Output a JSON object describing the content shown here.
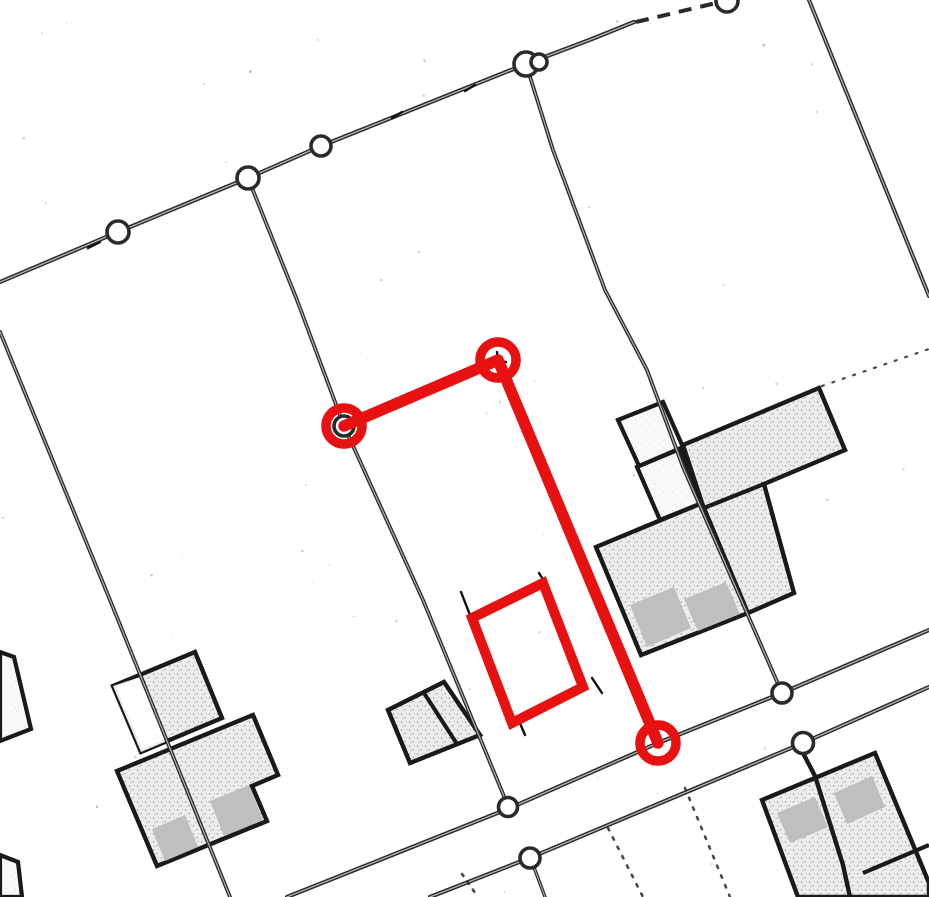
{
  "canvas": {
    "width": 929,
    "height": 897,
    "background": "#ffffff"
  },
  "palette": {
    "line": "#2a2a2a",
    "line_core": "#c9c9c9",
    "building_outline": "#1a1a1a",
    "stipple_bg": "#ededed",
    "stipple_light_bg": "#f9f9f9",
    "patch_gray": "#bfbfbf",
    "faint": "#a0a0a0",
    "speckle": "#9a9a9a",
    "red": "#e81111",
    "white": "#ffffff"
  },
  "roads": [
    {
      "name": "road-top",
      "width": 4.2,
      "points": [
        [
          0,
          282
        ],
        [
          118,
          232
        ],
        [
          248,
          178
        ],
        [
          321,
          146
        ],
        [
          526,
          64
        ],
        [
          592,
          39
        ],
        [
          634,
          22
        ]
      ]
    },
    {
      "name": "road-upper",
      "width": 4.2,
      "points": [
        [
          287,
          897
        ],
        [
          510,
          808
        ],
        [
          658,
          743
        ],
        [
          782,
          693
        ],
        [
          929,
          630
        ]
      ]
    },
    {
      "name": "road-lower",
      "width": 4.2,
      "points": [
        [
          430,
          897
        ],
        [
          532,
          857
        ],
        [
          803,
          743
        ],
        [
          929,
          687
        ]
      ]
    },
    {
      "name": "line-top-right",
      "width": 4.0,
      "points": [
        [
          809,
          0
        ],
        [
          929,
          296
        ]
      ]
    }
  ],
  "parcel_lines": [
    {
      "name": "parcel-line-a",
      "width": 3.8,
      "points": [
        [
          248,
          178
        ],
        [
          297,
          300
        ],
        [
          344,
          426
        ],
        [
          423,
          600
        ],
        [
          508,
          806
        ]
      ]
    },
    {
      "name": "parcel-line-b",
      "width": 3.8,
      "points": [
        [
          0,
          332
        ],
        [
          110,
          600
        ],
        [
          230,
          897
        ]
      ]
    },
    {
      "name": "parcel-line-c",
      "width": 3.8,
      "points": [
        [
          526,
          64
        ],
        [
          553,
          150
        ],
        [
          605,
          290
        ],
        [
          647,
          370
        ],
        [
          683,
          467
        ],
        [
          782,
          693
        ]
      ]
    },
    {
      "name": "spur-below-lower-road",
      "width": 3.4,
      "points": [
        [
          532,
          862
        ],
        [
          545,
          897
        ]
      ]
    }
  ],
  "dashed_lines": [
    {
      "name": "road-top-dashed-gap",
      "width": 4.0,
      "dash": "13 9",
      "points": [
        [
          636,
          22
        ],
        [
          716,
          3
        ]
      ]
    }
  ],
  "dotted_lines": [
    {
      "name": "dotted-between-roads-1",
      "width": 2.6,
      "dash": "2.5 7",
      "points": [
        [
          462,
          874
        ],
        [
          478,
          897
        ]
      ]
    },
    {
      "name": "dotted-below-road-1",
      "width": 2.6,
      "dash": "2.5 8",
      "points": [
        [
          608,
          828
        ],
        [
          643,
          897
        ]
      ]
    },
    {
      "name": "dotted-below-road-2",
      "width": 2.6,
      "dash": "2.5 8",
      "points": [
        [
          685,
          788
        ],
        [
          730,
          897
        ]
      ]
    },
    {
      "name": "dotted-ext-building-corner",
      "width": 2.2,
      "dash": "2 9",
      "points": [
        [
          822,
          386
        ],
        [
          929,
          349
        ]
      ]
    }
  ],
  "buildings_stippled": [
    {
      "name": "building-complex-upper-right",
      "points": [
        [
          683,
          445
        ],
        [
          819,
          388
        ],
        [
          845,
          450
        ],
        [
          764,
          484
        ],
        [
          794,
          593
        ],
        [
          748,
          613
        ],
        [
          641,
          655
        ],
        [
          596,
          547
        ],
        [
          702,
          503
        ]
      ]
    },
    {
      "name": "building-cluster-left-upper",
      "points": [
        [
          113,
          686
        ],
        [
          195,
          652
        ],
        [
          222,
          718
        ],
        [
          141,
          752
        ]
      ]
    },
    {
      "name": "building-cluster-left-lower",
      "points": [
        [
          117,
          771
        ],
        [
          253,
          715
        ],
        [
          278,
          775
        ],
        [
          252,
          786
        ],
        [
          267,
          821
        ],
        [
          157,
          866
        ]
      ]
    },
    {
      "name": "building-small-two-cell",
      "points": [
        [
          388,
          710
        ],
        [
          444,
          682
        ],
        [
          480,
          735
        ],
        [
          410,
          763
        ]
      ]
    },
    {
      "name": "building-bottom-right",
      "points": [
        [
          762,
          800
        ],
        [
          875,
          753
        ],
        [
          929,
          883
        ],
        [
          929,
          897
        ],
        [
          798,
          897
        ]
      ]
    }
  ],
  "buildings_white": [
    {
      "name": "annex-white-rect",
      "points": [
        [
          618,
          420
        ],
        [
          663,
          402
        ],
        [
          683,
          447
        ],
        [
          639,
          466
        ]
      ]
    },
    {
      "name": "courtyard-white",
      "points": [
        [
          637,
          467
        ],
        [
          680,
          449
        ],
        [
          702,
          503
        ],
        [
          660,
          520
        ]
      ]
    },
    {
      "name": "left-edge-building-top",
      "points": [
        [
          0,
          652
        ],
        [
          14,
          657
        ],
        [
          31,
          729
        ],
        [
          0,
          741
        ]
      ]
    },
    {
      "name": "left-edge-building-bottom",
      "points": [
        [
          0,
          855
        ],
        [
          18,
          862
        ],
        [
          22,
          897
        ],
        [
          0,
          897
        ]
      ]
    }
  ],
  "white_overlays": [
    {
      "name": "cluster-upper-white-part",
      "points": [
        [
          113,
          686
        ],
        [
          140,
          677
        ],
        [
          167,
          741
        ],
        [
          141,
          752
        ]
      ]
    }
  ],
  "gray_patches": [
    {
      "name": "patch-cluster-left-1",
      "points": [
        [
          152,
          829
        ],
        [
          185,
          815
        ],
        [
          198,
          847
        ],
        [
          165,
          861
        ]
      ]
    },
    {
      "name": "patch-cluster-left-2",
      "points": [
        [
          210,
          801
        ],
        [
          249,
          785
        ],
        [
          263,
          820
        ],
        [
          224,
          836
        ]
      ]
    },
    {
      "name": "patch-complex-1",
      "points": [
        [
          630,
          605
        ],
        [
          674,
          587
        ],
        [
          691,
          628
        ],
        [
          647,
          647
        ]
      ]
    },
    {
      "name": "patch-complex-2",
      "points": [
        [
          684,
          599
        ],
        [
          726,
          582
        ],
        [
          740,
          614
        ],
        [
          698,
          631
        ]
      ]
    },
    {
      "name": "patch-bottom-right-1",
      "points": [
        [
          777,
          813
        ],
        [
          815,
          797
        ],
        [
          828,
          827
        ],
        [
          790,
          843
        ]
      ]
    },
    {
      "name": "patch-bottom-right-2",
      "points": [
        [
          834,
          793
        ],
        [
          872,
          776
        ],
        [
          885,
          807
        ],
        [
          847,
          824
        ]
      ]
    }
  ],
  "building_walls": [
    {
      "name": "wall-complex-middle",
      "width": 4.2,
      "points": [
        [
          702,
          503
        ],
        [
          748,
          613
        ]
      ]
    },
    {
      "name": "wall-complex-leg-top",
      "width": 4.2,
      "points": [
        [
          704,
          508
        ],
        [
          764,
          484
        ]
      ]
    },
    {
      "name": "wall-two-cell-divider",
      "width": 4.0,
      "points": [
        [
          424,
          693
        ],
        [
          457,
          744
        ]
      ]
    },
    {
      "name": "wall-bottom-right-divider",
      "width": 4.4,
      "points": [
        [
          803,
          753
        ],
        [
          815,
          776
        ],
        [
          843,
          865
        ],
        [
          850,
          897
        ]
      ]
    },
    {
      "name": "wall-bottom-right-cross",
      "width": 4.2,
      "points": [
        [
          863,
          873
        ],
        [
          929,
          845
        ]
      ]
    }
  ],
  "survey_circles": [
    {
      "name": "junction-circle",
      "cx": 118,
      "cy": 232,
      "r": 11
    },
    {
      "name": "junction-circle",
      "cx": 248,
      "cy": 178,
      "r": 11
    },
    {
      "name": "junction-circle",
      "cx": 321,
      "cy": 146,
      "r": 10
    },
    {
      "name": "junction-circle",
      "cx": 526,
      "cy": 64,
      "r": 12
    },
    {
      "name": "junction-circle-small",
      "cx": 539,
      "cy": 62,
      "r": 8
    },
    {
      "name": "junction-circle-clipped",
      "cx": 727,
      "cy": 1,
      "r": 11
    },
    {
      "name": "junction-circle",
      "cx": 344,
      "cy": 426,
      "r": 10
    },
    {
      "name": "junction-circle",
      "cx": 508,
      "cy": 807,
      "r": 9.5
    },
    {
      "name": "junction-circle",
      "cx": 530,
      "cy": 858,
      "r": 10
    },
    {
      "name": "junction-circle",
      "cx": 782,
      "cy": 693,
      "r": 10
    },
    {
      "name": "junction-circle",
      "cx": 803,
      "cy": 743,
      "r": 10.5
    }
  ],
  "tick_marks": [
    {
      "name": "road-tick",
      "points": [
        [
          88,
          248
        ],
        [
          100,
          242
        ]
      ]
    },
    {
      "name": "road-tick",
      "points": [
        [
          392,
          118
        ],
        [
          402,
          112
        ]
      ]
    },
    {
      "name": "road-tick",
      "points": [
        [
          465,
          91
        ],
        [
          475,
          85
        ]
      ]
    },
    {
      "name": "corner-tick",
      "points": [
        [
          539,
          573
        ],
        [
          546,
          584
        ]
      ]
    },
    {
      "name": "corner-tick",
      "points": [
        [
          461,
          592
        ],
        [
          470,
          615
        ]
      ]
    },
    {
      "name": "corner-tick",
      "points": [
        [
          519,
          721
        ],
        [
          525,
          735
        ]
      ]
    },
    {
      "name": "corner-tick",
      "points": [
        [
          592,
          678
        ],
        [
          602,
          693
        ]
      ]
    },
    {
      "name": "survey-point-mark",
      "points": [
        [
          490,
          359
        ],
        [
          506,
          362
        ]
      ]
    },
    {
      "name": "survey-point-mark",
      "points": [
        [
          497,
          352
        ],
        [
          499,
          369
        ]
      ]
    }
  ],
  "faint_lines": [
    {
      "name": "pencil-line-1",
      "width": 1.6,
      "points": [
        [
          347,
          420
        ],
        [
          494,
          359
        ]
      ]
    },
    {
      "name": "pencil-line-2",
      "width": 1.6,
      "points": [
        [
          503,
          367
        ],
        [
          655,
          741
        ]
      ]
    }
  ],
  "red_annotation": {
    "stroke_polyline": 11.5,
    "stroke_rect": 10,
    "stroke_ring": 9.5,
    "ring_radius": 18,
    "polyline": {
      "name": "red-measure-polyline",
      "points": [
        [
          344,
          426
        ],
        [
          498,
          360
        ],
        [
          658,
          743
        ]
      ]
    },
    "rectangle": {
      "name": "red-planned-building-rect",
      "points": [
        [
          472,
          618
        ],
        [
          543,
          583
        ],
        [
          583,
          687
        ],
        [
          512,
          723
        ]
      ]
    },
    "handles": [
      {
        "name": "red-vertex-handle-1",
        "cx": 344,
        "cy": 426
      },
      {
        "name": "red-vertex-handle-2",
        "cx": 498,
        "cy": 360
      },
      {
        "name": "red-vertex-handle-3",
        "cx": 658,
        "cy": 743
      }
    ]
  },
  "speckle_count": 70
}
